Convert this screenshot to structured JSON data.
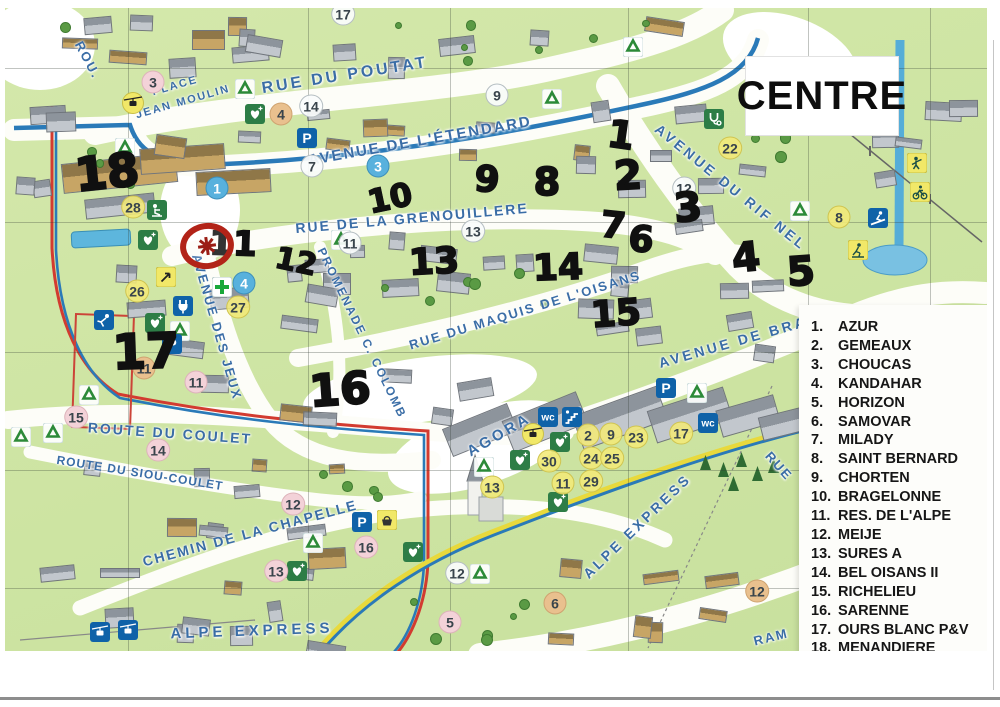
{
  "title": {
    "label": "CENTRE"
  },
  "agency": {
    "name": "AGENCE GIVERDON",
    "logo_color": "#e23b60",
    "text_color": "#d05d72"
  },
  "legend": {
    "items": [
      {
        "num": "1.",
        "name": "AZUR"
      },
      {
        "num": "2.",
        "name": "GEMEAUX"
      },
      {
        "num": "3.",
        "name": "CHOUCAS"
      },
      {
        "num": "4.",
        "name": "KANDAHAR"
      },
      {
        "num": "5.",
        "name": "HORIZON"
      },
      {
        "num": "6.",
        "name": "SAMOVAR"
      },
      {
        "num": "7.",
        "name": "MILADY"
      },
      {
        "num": "8.",
        "name": "SAINT BERNARD"
      },
      {
        "num": "9.",
        "name": "CHORTEN"
      },
      {
        "num": "10.",
        "name": "BRAGELONNE"
      },
      {
        "num": "11.",
        "name": "RES. DE L'ALPE"
      },
      {
        "num": "12.",
        "name": "MEIJE"
      },
      {
        "num": "13.",
        "name": "SURES A"
      },
      {
        "num": "14.",
        "name": "BEL OISANS II"
      },
      {
        "num": "15.",
        "name": "RICHELIEU"
      },
      {
        "num": "16.",
        "name": "SARENNE"
      },
      {
        "num": "17.",
        "name": "OURS BLANC P&V"
      },
      {
        "num": "18.",
        "name": "MENANDIERE"
      }
    ]
  },
  "map": {
    "streets": [
      {
        "label": "ROU.",
        "x": 88,
        "y": 60,
        "rot": 62,
        "size": 13,
        "sp": 2
      },
      {
        "label": "RUE DU POUTAT",
        "x": 345,
        "y": 76,
        "rot": -9,
        "size": 16,
        "sp": 3
      },
      {
        "label": "PLACE",
        "x": 175,
        "y": 86,
        "rot": -16,
        "size": 11,
        "sp": 2
      },
      {
        "label": "JEAN MOULIN",
        "x": 183,
        "y": 102,
        "rot": -16,
        "size": 11,
        "sp": 2
      },
      {
        "label": "AVENUE DE L'ÉTENDARD",
        "x": 420,
        "y": 141,
        "rot": -10,
        "size": 15,
        "sp": 2
      },
      {
        "label": "RUE DE LA GRENOUILLERE",
        "x": 412,
        "y": 218,
        "rot": -5,
        "size": 14,
        "sp": 2
      },
      {
        "label": "AVENUE DU RIF NEL",
        "x": 731,
        "y": 187,
        "rot": 39,
        "size": 14,
        "sp": 3
      },
      {
        "label": "RUE DU MAQUIS DE L'OISANS",
        "x": 525,
        "y": 310,
        "rot": -17,
        "size": 13,
        "sp": 2
      },
      {
        "label": "AVENUE DE BRA",
        "x": 733,
        "y": 342,
        "rot": -16,
        "size": 14,
        "sp": 3
      },
      {
        "label": "AVENUE DES JEUX",
        "x": 217,
        "y": 327,
        "rot": 74,
        "size": 13,
        "sp": 2
      },
      {
        "label": "PROMENADE C. COLOMB",
        "x": 362,
        "y": 333,
        "rot": 64,
        "size": 12,
        "sp": 2
      },
      {
        "label": "AGORA",
        "x": 499,
        "y": 435,
        "rot": -30,
        "size": 15,
        "sp": 3
      },
      {
        "label": "ROUTE DU COULET",
        "x": 170,
        "y": 433,
        "rot": 4,
        "size": 14,
        "sp": 2
      },
      {
        "label": "ROUTE DU SIOU-COULET",
        "x": 140,
        "y": 473,
        "rot": 9,
        "size": 12,
        "sp": 1
      },
      {
        "label": "CHEMIN DE LA CHAPELLE",
        "x": 250,
        "y": 533,
        "rot": -15,
        "size": 14,
        "sp": 2
      },
      {
        "label": "ALPE EXPRESS",
        "x": 252,
        "y": 631,
        "rot": -2,
        "size": 15,
        "sp": 4
      },
      {
        "label": "ALPE EXPRESS",
        "x": 637,
        "y": 526,
        "rot": -44,
        "size": 14,
        "sp": 3
      },
      {
        "label": "RUE",
        "x": 779,
        "y": 466,
        "rot": 48,
        "size": 13,
        "sp": 2
      },
      {
        "label": "RAM",
        "x": 771,
        "y": 637,
        "rot": -14,
        "size": 13,
        "sp": 2
      }
    ],
    "badges": [
      {
        "label": "17",
        "color": "white",
        "x": 343,
        "y": 14
      },
      {
        "label": "14",
        "color": "white",
        "x": 311,
        "y": 106
      },
      {
        "label": "9",
        "color": "white",
        "x": 497,
        "y": 95
      },
      {
        "label": "7",
        "color": "white",
        "x": 312,
        "y": 166
      },
      {
        "label": "12",
        "color": "white",
        "x": 684,
        "y": 188
      },
      {
        "label": "13",
        "color": "white",
        "x": 473,
        "y": 231
      },
      {
        "label": "11",
        "color": "white",
        "x": 350,
        "y": 243
      },
      {
        "label": "12",
        "color": "white",
        "x": 457,
        "y": 573
      },
      {
        "label": "3",
        "color": "pink",
        "x": 153,
        "y": 82
      },
      {
        "label": "11",
        "color": "pink",
        "x": 196,
        "y": 382
      },
      {
        "label": "15",
        "color": "pink",
        "x": 76,
        "y": 417
      },
      {
        "label": "14",
        "color": "pink",
        "x": 158,
        "y": 450
      },
      {
        "label": "12",
        "color": "pink",
        "x": 293,
        "y": 504
      },
      {
        "label": "13",
        "color": "pink",
        "x": 276,
        "y": 571
      },
      {
        "label": "16",
        "color": "pink",
        "x": 366,
        "y": 547
      },
      {
        "label": "5",
        "color": "pink",
        "x": 450,
        "y": 622
      },
      {
        "label": "4",
        "color": "tan",
        "x": 281,
        "y": 114
      },
      {
        "label": "11",
        "color": "tan",
        "x": 144,
        "y": 368
      },
      {
        "label": "6",
        "color": "tan",
        "x": 555,
        "y": 603
      },
      {
        "label": "12",
        "color": "tan",
        "x": 757,
        "y": 591
      },
      {
        "label": "22",
        "color": "yellow",
        "x": 730,
        "y": 148
      },
      {
        "label": "8",
        "color": "yellow",
        "x": 839,
        "y": 217
      },
      {
        "label": "28",
        "color": "yellow",
        "x": 133,
        "y": 207
      },
      {
        "label": "26",
        "color": "yellow",
        "x": 137,
        "y": 291
      },
      {
        "label": "27",
        "color": "yellow",
        "x": 238,
        "y": 307
      },
      {
        "label": "2",
        "color": "yellow",
        "x": 588,
        "y": 435
      },
      {
        "label": "9",
        "color": "yellow",
        "x": 611,
        "y": 434
      },
      {
        "label": "23",
        "color": "yellow",
        "x": 636,
        "y": 437
      },
      {
        "label": "17",
        "color": "yellow",
        "x": 681,
        "y": 433
      },
      {
        "label": "30",
        "color": "yellow",
        "x": 549,
        "y": 461
      },
      {
        "label": "24",
        "color": "yellow",
        "x": 591,
        "y": 458
      },
      {
        "label": "25",
        "color": "yellow",
        "x": 612,
        "y": 458
      },
      {
        "label": "11",
        "color": "yellow",
        "x": 563,
        "y": 483
      },
      {
        "label": "29",
        "color": "yellow",
        "x": 591,
        "y": 481
      },
      {
        "label": "13",
        "color": "yellow",
        "x": 492,
        "y": 487
      },
      {
        "label": "3",
        "color": "blue",
        "x": 378,
        "y": 166
      },
      {
        "label": "1",
        "color": "blue",
        "x": 217,
        "y": 188
      },
      {
        "label": "4",
        "color": "blue",
        "x": 244,
        "y": 283
      }
    ],
    "handwritten": [
      {
        "label": "18",
        "x": 107,
        "y": 172,
        "size": 46,
        "rot": -6
      },
      {
        "label": "11",
        "x": 233,
        "y": 244,
        "size": 34,
        "rot": 2
      },
      {
        "label": "12",
        "x": 296,
        "y": 262,
        "size": 30,
        "rot": 12
      },
      {
        "label": "17",
        "x": 146,
        "y": 352,
        "size": 48,
        "rot": -2
      },
      {
        "label": "16",
        "x": 340,
        "y": 390,
        "size": 44,
        "rot": -4
      },
      {
        "label": "10",
        "x": 390,
        "y": 198,
        "size": 32,
        "rot": -12
      },
      {
        "label": "9",
        "x": 487,
        "y": 180,
        "size": 36,
        "rot": 5
      },
      {
        "label": "8",
        "x": 547,
        "y": 182,
        "size": 38,
        "rot": 0
      },
      {
        "label": "1",
        "x": 621,
        "y": 135,
        "size": 38,
        "rot": 8
      },
      {
        "label": "2",
        "x": 628,
        "y": 176,
        "size": 40,
        "rot": -3
      },
      {
        "label": "3",
        "x": 688,
        "y": 208,
        "size": 40,
        "rot": -5
      },
      {
        "label": "7",
        "x": 613,
        "y": 226,
        "size": 36,
        "rot": 6
      },
      {
        "label": "6",
        "x": 641,
        "y": 240,
        "size": 36,
        "rot": 4
      },
      {
        "label": "13",
        "x": 434,
        "y": 262,
        "size": 36,
        "rot": -3
      },
      {
        "label": "14",
        "x": 558,
        "y": 268,
        "size": 36,
        "rot": -2
      },
      {
        "label": "15",
        "x": 616,
        "y": 314,
        "size": 36,
        "rot": -4
      },
      {
        "label": "4",
        "x": 746,
        "y": 258,
        "size": 40,
        "rot": -6
      },
      {
        "label": "5",
        "x": 801,
        "y": 272,
        "size": 40,
        "rot": -4
      }
    ],
    "icons": [
      {
        "type": "recycle",
        "x": 125,
        "y": 148
      },
      {
        "type": "recycle",
        "x": 245,
        "y": 89
      },
      {
        "type": "recycle",
        "x": 552,
        "y": 99
      },
      {
        "type": "recycle",
        "x": 633,
        "y": 47
      },
      {
        "type": "recycle",
        "x": 800,
        "y": 211
      },
      {
        "type": "recycle",
        "x": 341,
        "y": 240
      },
      {
        "type": "recycle",
        "x": 180,
        "y": 331
      },
      {
        "type": "recycle",
        "x": 89,
        "y": 395
      },
      {
        "type": "recycle",
        "x": 53,
        "y": 433
      },
      {
        "type": "recycle",
        "x": 21,
        "y": 437
      },
      {
        "type": "recycle",
        "x": 484,
        "y": 467
      },
      {
        "type": "recycle",
        "x": 697,
        "y": 393
      },
      {
        "type": "recycle",
        "x": 313,
        "y": 543
      },
      {
        "type": "recycle",
        "x": 480,
        "y": 574
      },
      {
        "type": "parking",
        "x": 307,
        "y": 138
      },
      {
        "type": "parking",
        "x": 172,
        "y": 344
      },
      {
        "type": "parking",
        "x": 666,
        "y": 388
      },
      {
        "type": "parking",
        "x": 362,
        "y": 522
      },
      {
        "type": "wc",
        "x": 548,
        "y": 417
      },
      {
        "type": "wc",
        "x": 708,
        "y": 423
      },
      {
        "type": "stairs",
        "x": 572,
        "y": 417
      },
      {
        "type": "doctor",
        "x": 714,
        "y": 119
      },
      {
        "type": "gondola-circle",
        "x": 133,
        "y": 103
      },
      {
        "type": "gondola-circle",
        "x": 533,
        "y": 434
      },
      {
        "type": "heart",
        "x": 255,
        "y": 114
      },
      {
        "type": "heart",
        "x": 148,
        "y": 240
      },
      {
        "type": "heart",
        "x": 155,
        "y": 323
      },
      {
        "type": "heart",
        "x": 560,
        "y": 442
      },
      {
        "type": "heart",
        "x": 520,
        "y": 460
      },
      {
        "type": "heart",
        "x": 558,
        "y": 502
      },
      {
        "type": "heart",
        "x": 297,
        "y": 571
      },
      {
        "type": "heart",
        "x": 413,
        "y": 552
      },
      {
        "type": "plug",
        "x": 183,
        "y": 306
      },
      {
        "type": "person",
        "x": 157,
        "y": 210
      },
      {
        "type": "person-slip",
        "x": 104,
        "y": 320
      },
      {
        "type": "pharmacy",
        "x": 222,
        "y": 287
      },
      {
        "type": "shop",
        "x": 387,
        "y": 520
      },
      {
        "type": "info-arrow",
        "x": 166,
        "y": 277
      },
      {
        "type": "ski-jump",
        "x": 878,
        "y": 218
      },
      {
        "type": "sport-tennis",
        "x": 917,
        "y": 163
      },
      {
        "type": "sport-bike",
        "x": 920,
        "y": 192
      },
      {
        "type": "sport-skate",
        "x": 858,
        "y": 250
      },
      {
        "type": "gondola-square",
        "x": 100,
        "y": 632
      },
      {
        "type": "gondola-square",
        "x": 128,
        "y": 630
      }
    ],
    "marker": {
      "x": 207,
      "y": 246,
      "meaning": "red hand-drawn circle"
    },
    "colors": {
      "road_blue": "#2a7ab8",
      "route_red": "#d23b30",
      "express_yellow": "#e8d93c",
      "water": "#55add8",
      "grass": "#cde4a2"
    }
  }
}
